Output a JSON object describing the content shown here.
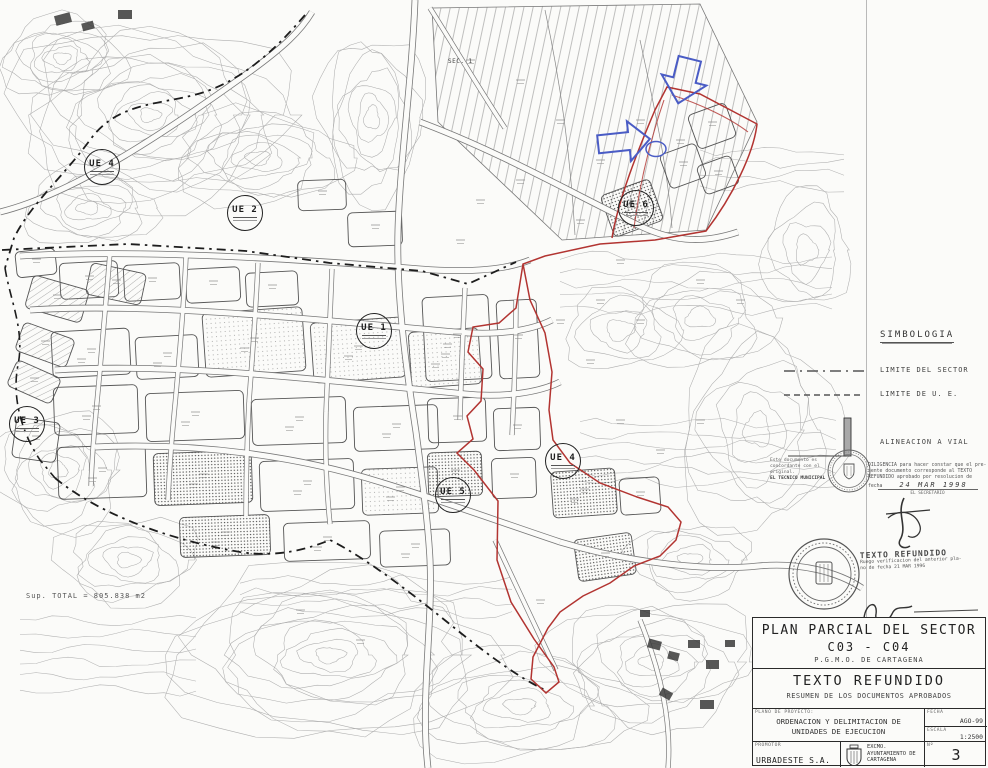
{
  "map": {
    "sec_label": "SEC. 1",
    "sup_total": "Sup. TOTAL = 805.838 m2",
    "ue_markers": [
      {
        "label": "UE 4"
      },
      {
        "label": "UE 2"
      },
      {
        "label": "UE 3"
      },
      {
        "label": "UE 1"
      },
      {
        "label": "UE 5"
      },
      {
        "label": "UE 4"
      },
      {
        "label": "UE 6"
      }
    ]
  },
  "legend": {
    "title": "SIMBOLOGIA",
    "items": [
      {
        "symbol": "dash-dot-line",
        "label": "LIMITE DEL SECTOR"
      },
      {
        "symbol": "dashed-line",
        "label": "LIMITE DE U. E."
      },
      {
        "symbol": "corner-thick-line",
        "label": "ALINEACION A VIAL"
      }
    ]
  },
  "stamps": {
    "verification_note": {
      "line1": "Este documento es",
      "line2": "concordante con el",
      "line3": "original.",
      "line4": "EL TECNICO MUNICIPAL"
    },
    "diligencia": {
      "line1": "DILIGENCIA para hacer constar que el pre-",
      "line2": "sente documento corresponde al TEXTO",
      "line3": "REFUNDIDO aprobado por resolucion de",
      "line4": "fecha",
      "date": "24 MAR 1998",
      "signer": "EL SECRETARIO"
    },
    "texto_refundido_stamp": {
      "title": "TEXTO REFUNDIDO",
      "line1": "Ruego verificacion del anterior pla-",
      "line2": "no de fecha 21 MAR 1996"
    }
  },
  "title_block": {
    "title": "PLAN PARCIAL DEL SECTOR",
    "sector": "C03 - C04",
    "subtitle": "P.G.M.O. DE CARTAGENA",
    "doc_title": "TEXTO REFUNDIDO",
    "doc_subtitle": "RESUMEN DE LOS DOCUMENTOS APROBADOS",
    "plan_label": "PLANO DE PROYECTO:",
    "plan_name_line1": "ORDENACION Y DELIMITACION DE",
    "plan_name_line2": "UNIDADES DE EJECUCION",
    "fecha_label": "FECHA",
    "fecha_value": "AGO-99",
    "escala_label": "ESCALA",
    "escala_value": "1:2500",
    "promotor_label": "PROMOTOR",
    "promotor_value": "URBADESTE S.A.",
    "ayuntamiento_line1": "EXCMO.",
    "ayuntamiento_line2": "AYUNTAMIENTO DE",
    "ayuntamiento_line3": "CARTAGENA",
    "num_label": "Nº",
    "num_value": "3"
  },
  "colors": {
    "sector_red": "#b23431",
    "annotation_blue": "#4a5cc5",
    "boundary_ink": "#1d1d1d"
  }
}
